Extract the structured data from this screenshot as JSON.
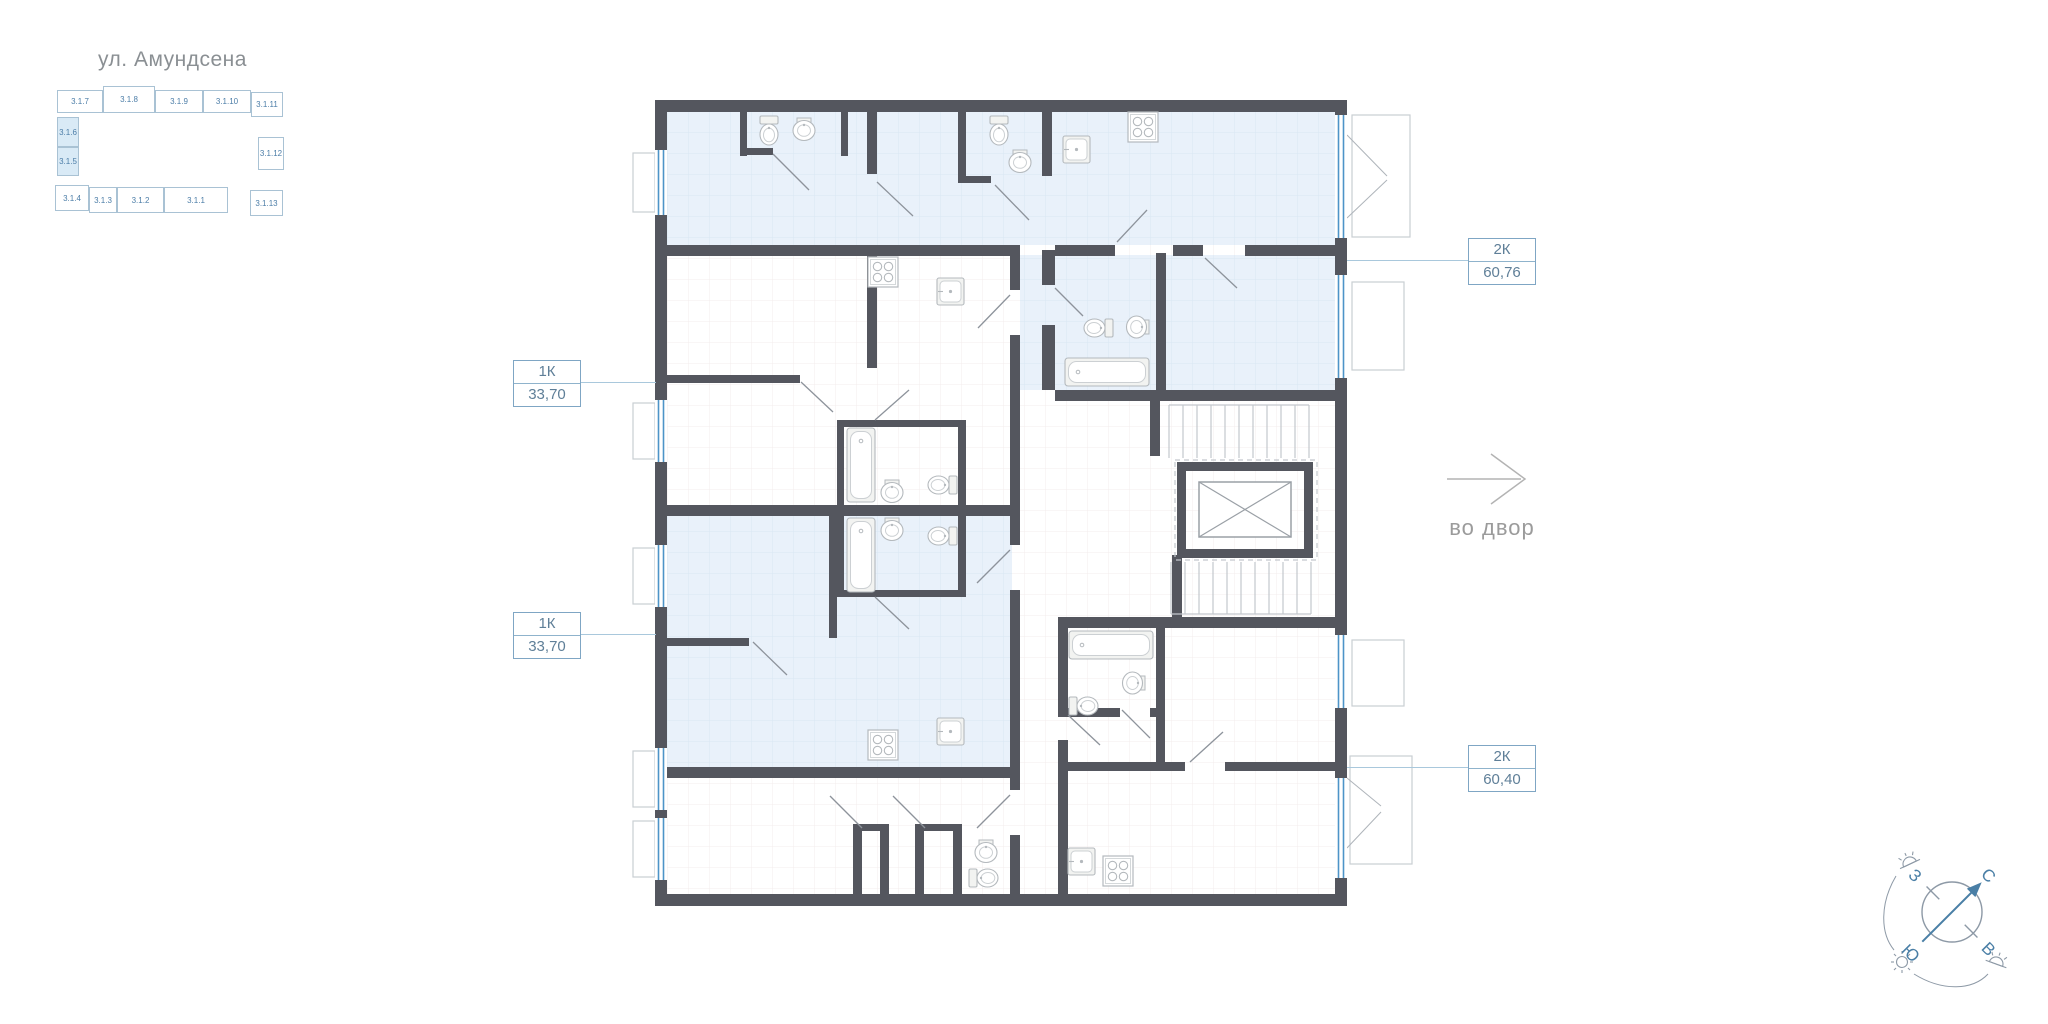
{
  "street": {
    "label": "ул. Амундсена"
  },
  "minimap": {
    "cells": [
      {
        "id": "3.1.7"
      },
      {
        "id": "3.1.8"
      },
      {
        "id": "3.1.9"
      },
      {
        "id": "3.1.10"
      },
      {
        "id": "3.1.11"
      },
      {
        "id": "3.1.6"
      },
      {
        "id": "3.1.5"
      },
      {
        "id": "3.1.12"
      },
      {
        "id": "3.1.4"
      },
      {
        "id": "3.1.3"
      },
      {
        "id": "3.1.2"
      },
      {
        "id": "3.1.1"
      },
      {
        "id": "3.1.13"
      }
    ],
    "highlighted": [
      "3.1.6",
      "3.1.5"
    ]
  },
  "apartments": [
    {
      "type": "1К",
      "area": "33,70"
    },
    {
      "type": "1К",
      "area": "33,70"
    },
    {
      "type": "2К",
      "area": "60,76"
    },
    {
      "type": "2К",
      "area": "60,40"
    }
  ],
  "courtyard": {
    "label": "во двор"
  },
  "compass": {
    "north": "С",
    "east": "В",
    "south": "Ю",
    "west": "З"
  },
  "colors": {
    "wall": "#54565e",
    "room_highlight": "#e9f1fa",
    "window": "#4d94c8",
    "label_text": "#5f7f98",
    "label_border": "#7fa6c4",
    "minimap_text": "#4d7ea8"
  }
}
